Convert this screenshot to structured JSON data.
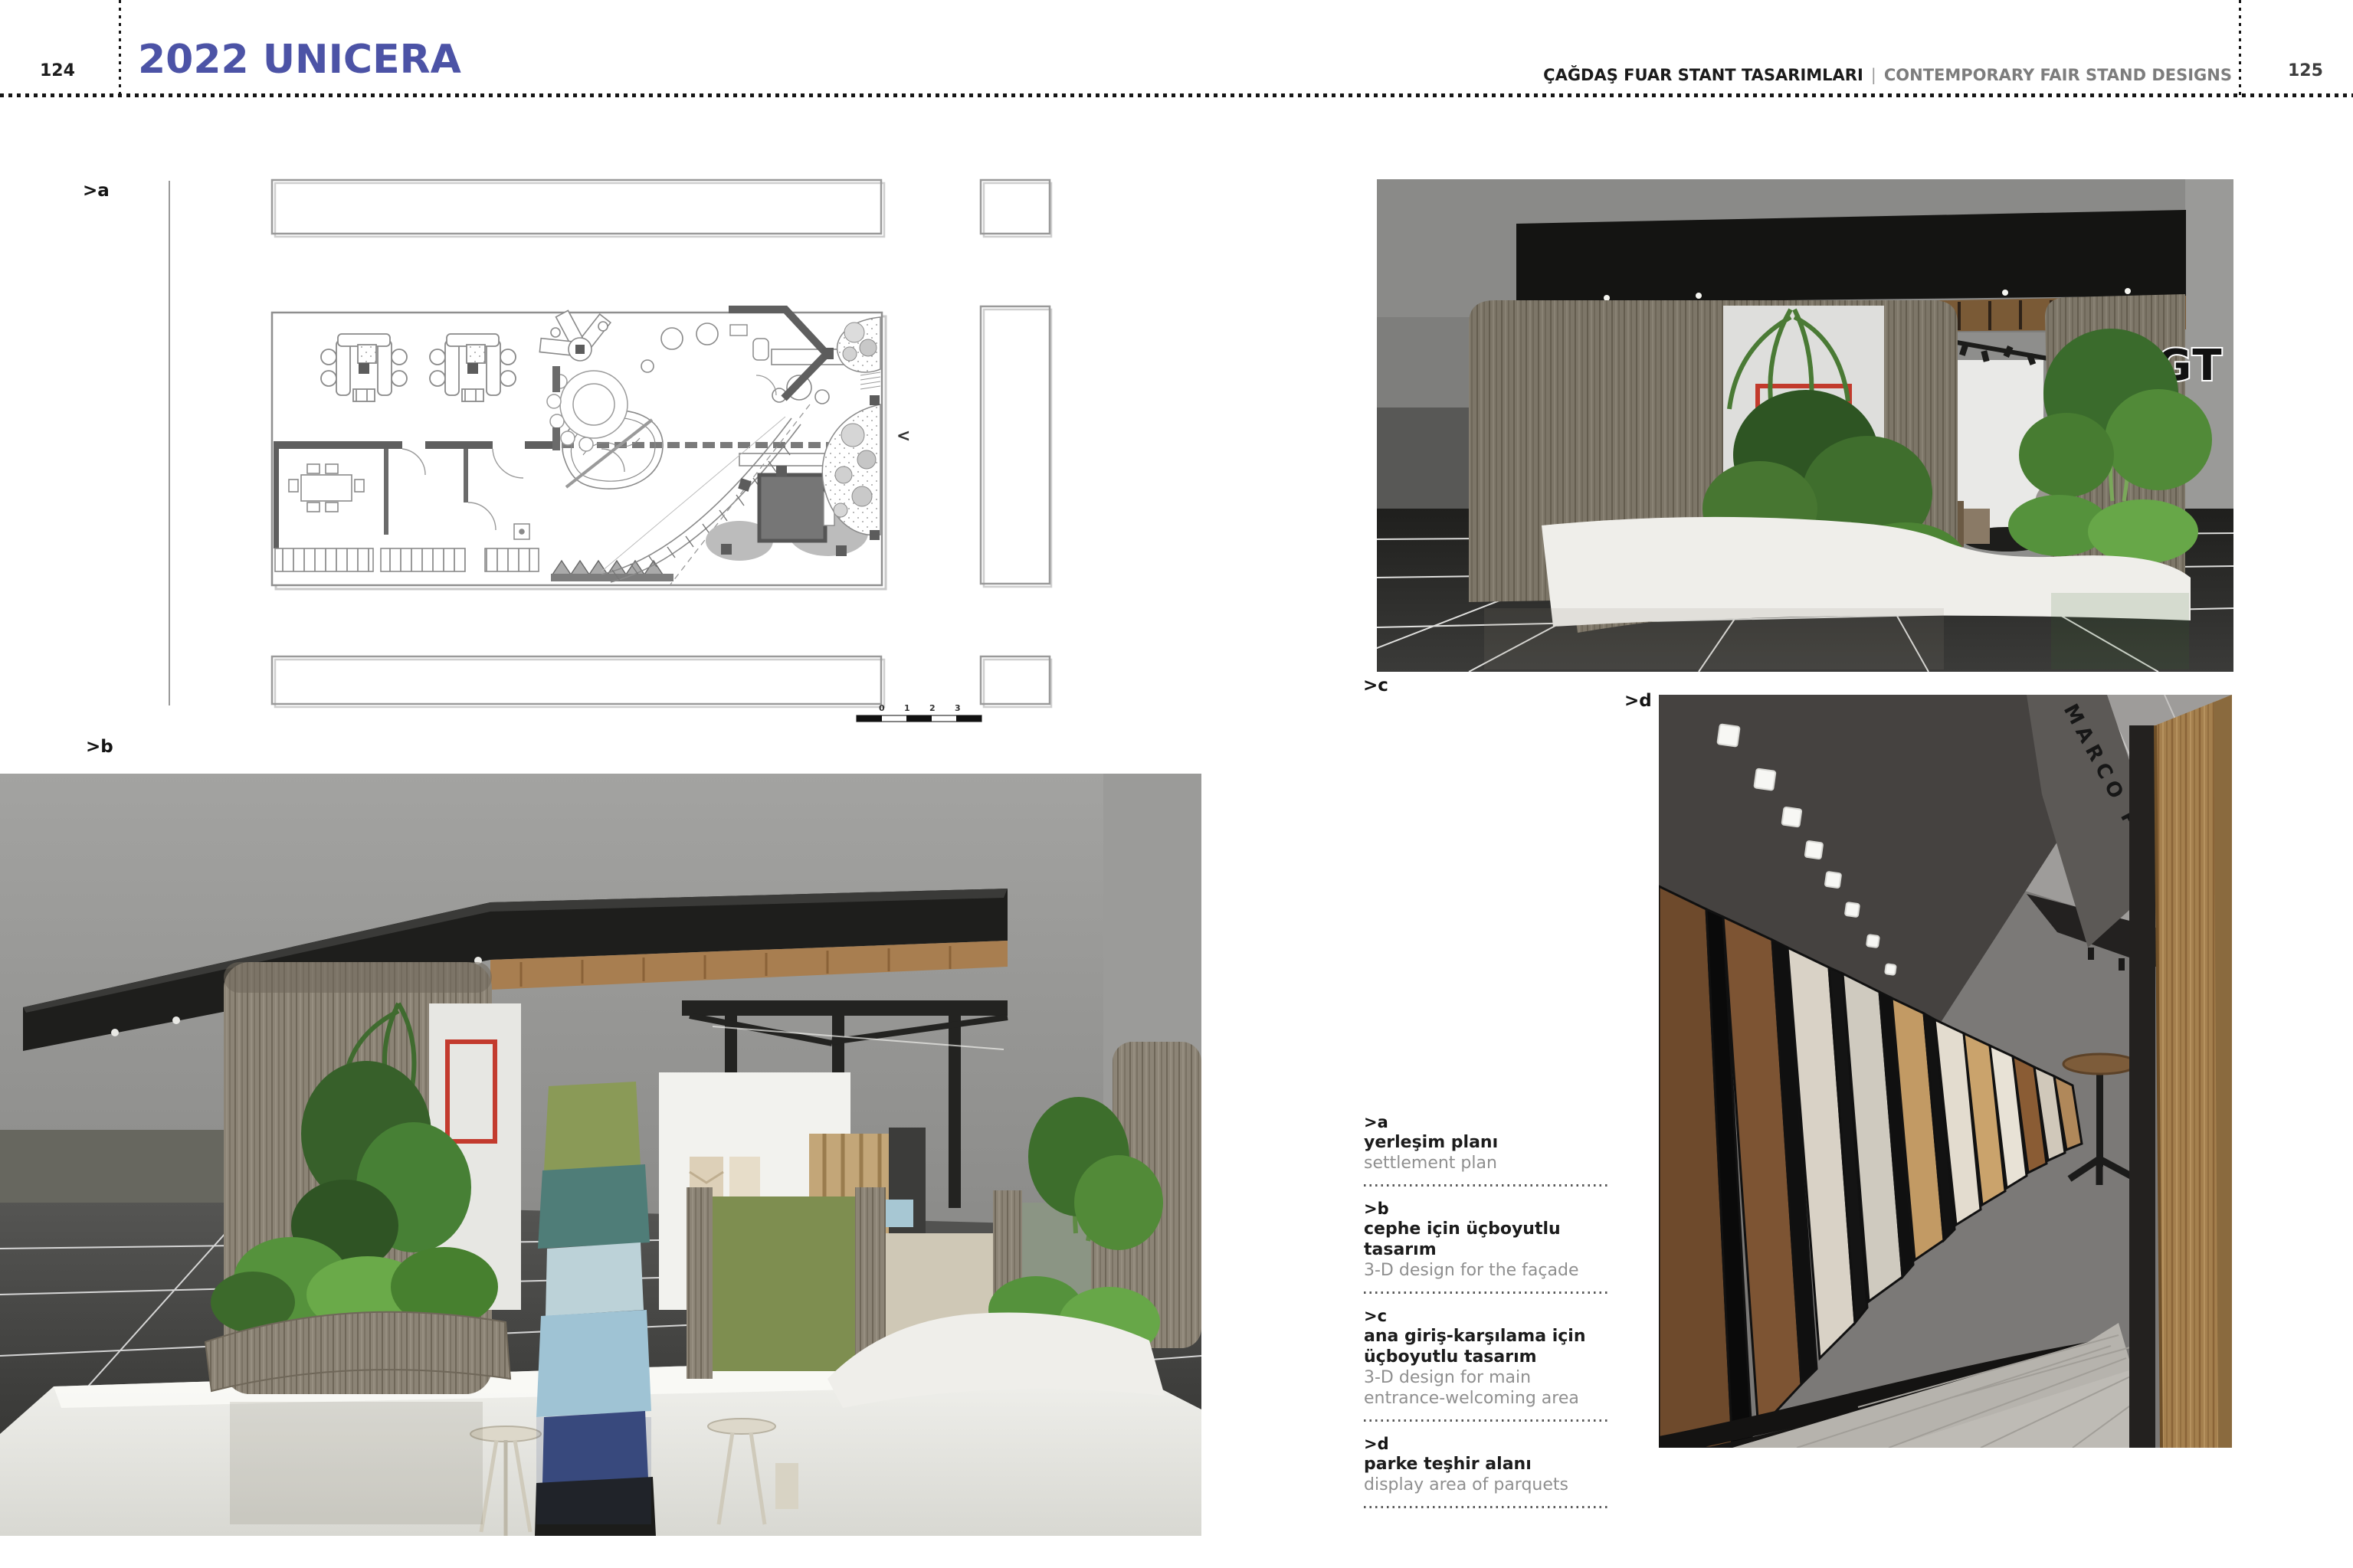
{
  "page": {
    "left_number": "124",
    "right_number": "125",
    "left_title": "2022 UNICERA",
    "right_title_tr": "ÇAĞDAŞ FUAR STANT TASARIMLARI",
    "right_title_sep": "|",
    "right_title_en": "CONTEMPORARY FAIR STAND DESIGNS"
  },
  "labels": {
    "a": ">a",
    "b": ">b",
    "c": ">c",
    "d": ">d"
  },
  "plan": {
    "scale_labels": [
      "0",
      "1",
      "2",
      "3"
    ],
    "nav_arrow": "<"
  },
  "renders": {
    "agt_logo_text": "AGT",
    "marco_polo_text": "MARCO POLO"
  },
  "captions": [
    {
      "id": ">a",
      "tr": "yerleşim planı",
      "en": "settlement plan"
    },
    {
      "id": ">b",
      "tr": "cephe için üçboyutlu tasarım",
      "en": "3-D design for the façade"
    },
    {
      "id": ">c",
      "tr": "ana giriş-karşılama için üçboyutlu tasarım",
      "en": "3-D design for main entrance-welcoming area"
    },
    {
      "id": ">d",
      "tr": "parke teşhir alanı",
      "en": "display area of parquets"
    }
  ],
  "colors": {
    "accent_blue": "#4c53a6",
    "caption_gray": "#8f8f8f",
    "header_gray": "#7d7d7d"
  }
}
